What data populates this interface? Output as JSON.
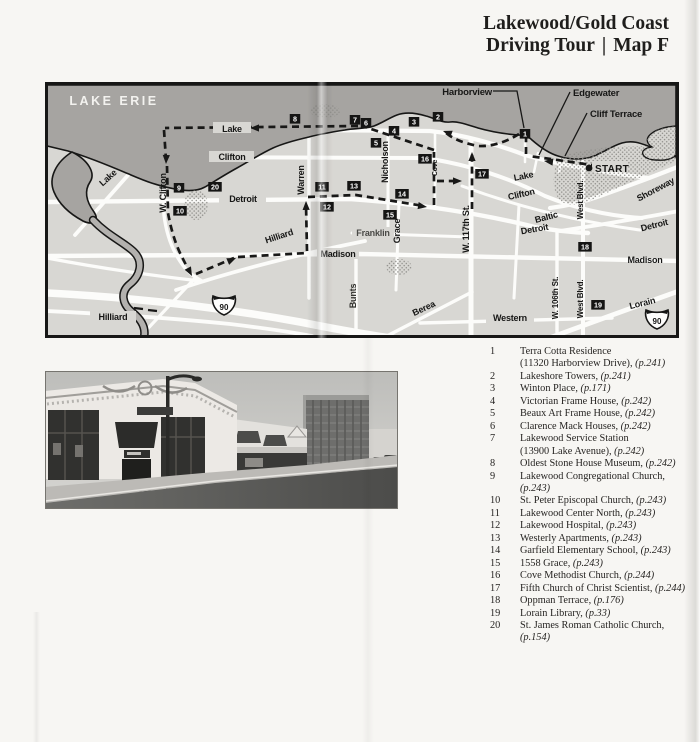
{
  "page": {
    "title_line1": "Lakewood/Gold Coast",
    "title_line2_left": "Driving Tour",
    "title_separator": "|",
    "title_line2_right": "Map F"
  },
  "map": {
    "water_label": "LAKE ERIE",
    "start_label": "START",
    "interstate_shield_label": "90",
    "colors": {
      "land": "#d8d7d3",
      "water": "#a6a4a1",
      "river": "#b3b1ae",
      "road": "#fcfcfa",
      "ink": "#171716",
      "route": "#181817"
    },
    "callouts": [
      {
        "t": "Harborview",
        "x": 492,
        "y": 95,
        "anchor": "end"
      },
      {
        "t": "Edgewater",
        "x": 573,
        "y": 96,
        "anchor": "start"
      },
      {
        "t": "Cliff Terrace",
        "x": 590,
        "y": 117,
        "anchor": "start"
      }
    ],
    "street_labels": [
      {
        "t": "LAKE ERIE",
        "x": 114,
        "y": 105,
        "s": 12.5,
        "c": "#f3f2ef",
        "ls": 2.5
      },
      {
        "t": "Lake",
        "x": 110,
        "y": 180,
        "r": -42
      },
      {
        "t": "Lake",
        "x": 232,
        "y": 132,
        "bg": [
          213,
          122,
          38,
          11
        ]
      },
      {
        "t": "Clifton",
        "x": 232,
        "y": 160,
        "bg": [
          209,
          151,
          45,
          11
        ]
      },
      {
        "t": "W. Clifton",
        "x": 166,
        "y": 193,
        "r": -90
      },
      {
        "t": "Detroit",
        "x": 243,
        "y": 202,
        "bg": [
          219,
          193,
          47,
          11
        ]
      },
      {
        "t": "Warren",
        "x": 304,
        "y": 180,
        "r": -90
      },
      {
        "t": "Nicholson",
        "x": 388,
        "y": 162,
        "r": -90
      },
      {
        "t": "Cove",
        "x": 437,
        "y": 168,
        "r": -90,
        "s": 7
      },
      {
        "t": "Grace",
        "x": 400,
        "y": 231,
        "r": -90
      },
      {
        "t": "Franklin",
        "x": 373,
        "y": 236,
        "bg": [
          352,
          227,
          42,
          11
        ],
        "c": "#4a4a47"
      },
      {
        "t": "Bunts",
        "x": 356,
        "y": 296,
        "r": -90,
        "c": "#33332f"
      },
      {
        "t": "Hilliard",
        "x": 280,
        "y": 239,
        "r": -18
      },
      {
        "t": "Madison",
        "x": 338,
        "y": 257,
        "bg": [
          317,
          248,
          42,
          11
        ]
      },
      {
        "t": "Hilliard",
        "x": 113,
        "y": 320,
        "bg": [
          90,
          311,
          46,
          11
        ]
      },
      {
        "t": "W. 117th St.",
        "x": 469,
        "y": 229,
        "r": -90
      },
      {
        "t": "Lake",
        "x": 524,
        "y": 179,
        "r": -11
      },
      {
        "t": "Clifton",
        "x": 522,
        "y": 197,
        "r": -13
      },
      {
        "t": "Baltic",
        "x": 547,
        "y": 220,
        "r": -15
      },
      {
        "t": "Detroit",
        "x": 535,
        "y": 232,
        "r": -10
      },
      {
        "t": "Detroit",
        "x": 655,
        "y": 228,
        "r": -14
      },
      {
        "t": "Madison",
        "x": 645,
        "y": 263
      },
      {
        "t": "W. 106th St.",
        "x": 558,
        "y": 298,
        "r": -90,
        "s": 8
      },
      {
        "t": "West Blvd.",
        "x": 583,
        "y": 200,
        "r": -90,
        "s": 8
      },
      {
        "t": "West Blvd.",
        "x": 583,
        "y": 299,
        "r": -90,
        "s": 8
      },
      {
        "t": "Shoreway",
        "x": 657,
        "y": 192,
        "r": -28
      },
      {
        "t": "Berea",
        "x": 425,
        "y": 311,
        "r": -25
      },
      {
        "t": "Western",
        "x": 510,
        "y": 321,
        "bg": [
          486,
          312,
          48,
          11
        ]
      },
      {
        "t": "Lorain",
        "x": 643,
        "y": 306,
        "r": -14
      }
    ],
    "markers": [
      {
        "n": "1",
        "x": 525,
        "y": 134
      },
      {
        "n": "2",
        "x": 438,
        "y": 117
      },
      {
        "n": "3",
        "x": 414,
        "y": 122
      },
      {
        "n": "4",
        "x": 394,
        "y": 131
      },
      {
        "n": "5",
        "x": 376,
        "y": 143
      },
      {
        "n": "6",
        "x": 366,
        "y": 123
      },
      {
        "n": "7",
        "x": 355,
        "y": 120
      },
      {
        "n": "8",
        "x": 295,
        "y": 119
      },
      {
        "n": "9",
        "x": 179,
        "y": 188
      },
      {
        "n": "10",
        "x": 180,
        "y": 211
      },
      {
        "n": "11",
        "x": 322,
        "y": 187
      },
      {
        "n": "12",
        "x": 327,
        "y": 207
      },
      {
        "n": "13",
        "x": 354,
        "y": 186
      },
      {
        "n": "14",
        "x": 402,
        "y": 194
      },
      {
        "n": "15",
        "x": 390,
        "y": 215
      },
      {
        "n": "16",
        "x": 425,
        "y": 159
      },
      {
        "n": "17",
        "x": 482,
        "y": 174
      },
      {
        "n": "18",
        "x": 585,
        "y": 247
      },
      {
        "n": "19",
        "x": 598,
        "y": 305
      },
      {
        "n": "20",
        "x": 215,
        "y": 187
      }
    ]
  },
  "photo": {
    "description": "Black-and-white photograph of a commercial street: low storefront buildings with large display windows and awnings in the foreground, a street lamp, and a tall office tower in the background"
  },
  "legend": {
    "items": [
      {
        "n": "1",
        "text": "Terra Cotta Residence",
        "text2": "(11320 Harborview Drive)",
        "page": "(p.241)"
      },
      {
        "n": "2",
        "text": "Lakeshore Towers",
        "page": "(p.241)"
      },
      {
        "n": "3",
        "text": "Winton Place",
        "page": "(p.171)"
      },
      {
        "n": "4",
        "text": "Victorian Frame House",
        "page": "(p.242)"
      },
      {
        "n": "5",
        "text": "Beaux Art Frame House",
        "page": "(p.242)"
      },
      {
        "n": "6",
        "text": "Clarence Mack Houses",
        "page": "(p.242)"
      },
      {
        "n": "7",
        "text": "Lakewood Service Station",
        "text2": "(13900 Lake Avenue)",
        "page": "(p.242)"
      },
      {
        "n": "8",
        "text": "Oldest Stone House Museum",
        "page": "(p.242)"
      },
      {
        "n": "9",
        "text": "Lakewood Congregational Church",
        "page": "(p.243)"
      },
      {
        "n": "10",
        "text": "St. Peter Episcopal Church",
        "page": "(p.243)"
      },
      {
        "n": "11",
        "text": "Lakewood Center North",
        "page": "(p.243)"
      },
      {
        "n": "12",
        "text": "Lakewood Hospital",
        "page": "(p.243)"
      },
      {
        "n": "13",
        "text": "Westerly Apartments",
        "page": "(p.243)"
      },
      {
        "n": "14",
        "text": "Garfield Elementary School",
        "page": "(p.243)"
      },
      {
        "n": "15",
        "text": "1558 Grace",
        "page": "(p.243)"
      },
      {
        "n": "16",
        "text": "Cove Methodist Church",
        "page": "(p.244)"
      },
      {
        "n": "17",
        "text": "Fifth Church of Christ Scientist",
        "page": "(p.244)"
      },
      {
        "n": "18",
        "text": "Oppman Terrace",
        "page": "(p.176)"
      },
      {
        "n": "19",
        "text": "Lorain Library",
        "page": "(p.33)"
      },
      {
        "n": "20",
        "text": "St. James Roman Catholic Church",
        "page": "(p.154)"
      }
    ]
  }
}
